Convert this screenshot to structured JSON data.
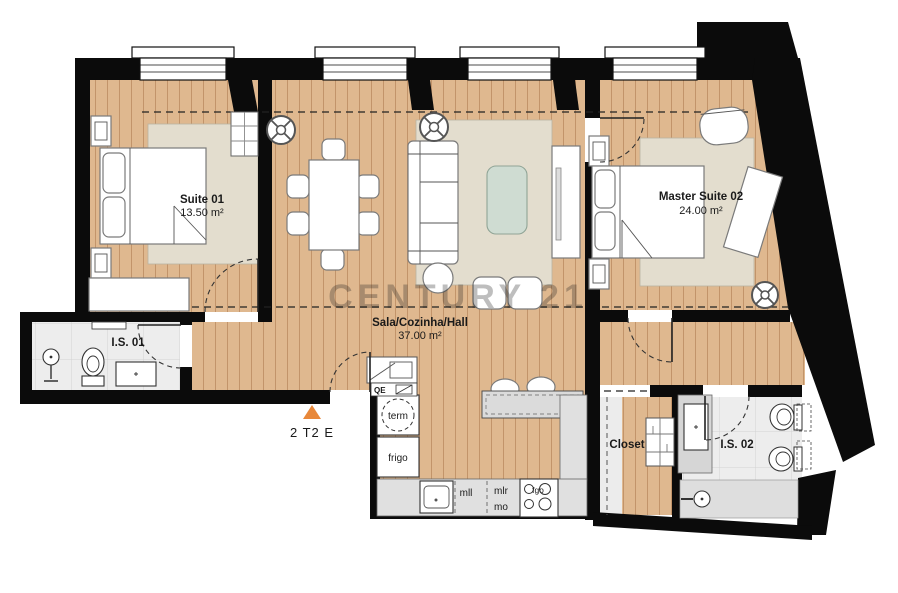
{
  "watermark": "CENTURY 21",
  "marker": {
    "label": "2 T2 E"
  },
  "rooms": {
    "suite01": {
      "name": "Suite 01",
      "area": "13.50 m²"
    },
    "master": {
      "name": "Master Suite 02",
      "area": "24.00 m²"
    },
    "sala": {
      "name": "Sala/Cozinha/Hall",
      "area": "37.00 m²"
    },
    "is01": {
      "name": "I.S. 01"
    },
    "is02": {
      "name": "I.S. 02"
    },
    "closet": {
      "name": "Closet"
    }
  },
  "appliances": {
    "term": "term",
    "frigo": "frigo",
    "mll": "mll",
    "mlr": "mlr",
    "mo": "mo",
    "fgo": "fgo",
    "qe": "QE"
  },
  "colors": {
    "accent_orange": "#E8883A",
    "wood_floor": "#DFB88F",
    "wall_black": "#0B0B0B",
    "rug_beige": "#E3DDCE",
    "table_green": "#CFDCD2"
  }
}
